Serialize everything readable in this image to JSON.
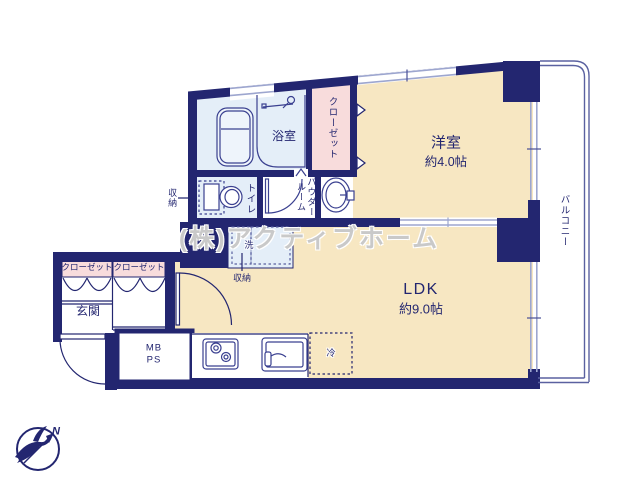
{
  "watermark": "(株)アクティブホーム",
  "compass": {
    "north": "N"
  },
  "labels": {
    "bathroom": "浴室",
    "closet_main": "クローゼット",
    "western_room": "洋室",
    "western_room_size": "約4.0帖",
    "toilet": "トイレ",
    "powder_room": "パウダー\nルーム",
    "storage_toilet": "収納",
    "washer": "洗",
    "storage_hall": "収納",
    "closet_hall_1": "クローゼット",
    "closet_hall_2": "クローゼット",
    "genkan": "玄関",
    "mb": "MB",
    "ps": "PS",
    "ldk": "LDK",
    "ldk_size": "約9.0帖",
    "fridge": "冷",
    "balcony": "バルコニー"
  },
  "colors": {
    "wall": "#232670",
    "room_cream": "#f7e7c2",
    "room_blue": "#e4eef8",
    "room_pink": "#f8dcdc",
    "window_gray": "#9da6cf"
  }
}
